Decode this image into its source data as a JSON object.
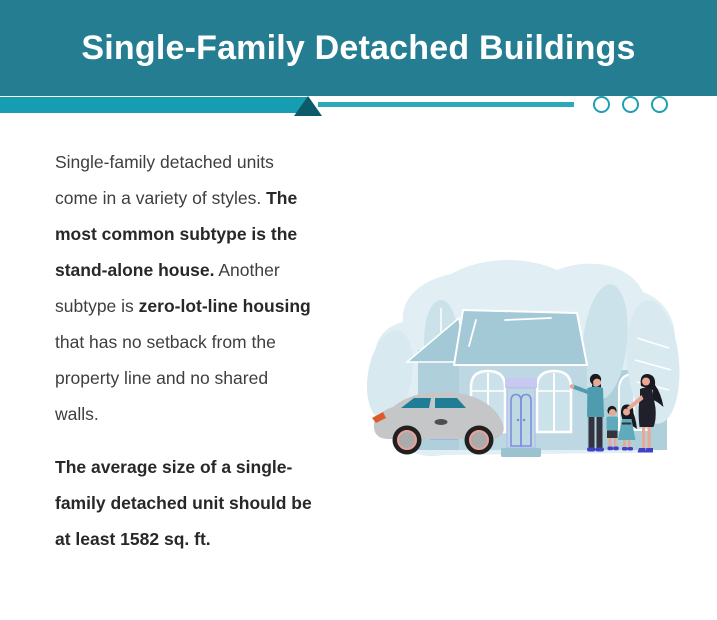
{
  "header": {
    "title": "Single-Family Detached Buildings"
  },
  "divider": {
    "circle_count": 3
  },
  "colors": {
    "page_bg": "#FFFFFF",
    "header_bg": "#247D90",
    "divider_bar": "#169DB2",
    "divider_line": "#2BA9BA",
    "divider_triangle": "#0D5A6A",
    "divider_circle": "#1E9FB2",
    "text_regular": "#3E3E3E",
    "text_bold": "#282828"
  },
  "content": {
    "paragraphs": [
      {
        "lines": [
          [
            {
              "t": "Single-family detached units",
              "b": false
            }
          ],
          [
            {
              "t": "come in a variety of styles. ",
              "b": false
            },
            {
              "t": "The",
              "b": true
            }
          ],
          [
            {
              "t": "most common subtype is the",
              "b": true
            }
          ],
          [
            {
              "t": "stand-alone house.",
              "b": true
            },
            {
              "t": " Another",
              "b": false
            }
          ],
          [
            {
              "t": "subtype is ",
              "b": false
            },
            {
              "t": "zero-lot-line housing",
              "b": true
            }
          ],
          [
            {
              "t": "that has no setback from the",
              "b": false
            }
          ],
          [
            {
              "t": "property line and no shared",
              "b": false
            }
          ],
          [
            {
              "t": "walls.",
              "b": false
            }
          ]
        ]
      },
      {
        "lines": [
          [
            {
              "t": "The average size of a single-",
              "b": true
            }
          ],
          [
            {
              "t": "family detached unit should be",
              "b": true
            }
          ],
          [
            {
              "t": "at least 1582 sq. ft.",
              "b": true
            }
          ]
        ]
      }
    ]
  },
  "illustration": {
    "name": "family-house-illustration",
    "description": "Flat vector scene: light blue detached house with arched windows, gray car parked in front, family of four (dad, son, daughter, mom) standing at right",
    "palette": {
      "blob": "#E1EEF3",
      "leaf": "#CBE2EA",
      "leaf_light": "#D8E9EF",
      "roof": "#A3C8D6",
      "wall": "#BDD8E2",
      "wall_dark": "#AFCFDB",
      "window_glass": "#CBE2EB",
      "door_accent": "#7F8DE0",
      "door_lintel": "#C9C8F0",
      "step": "#9CC2D0",
      "car_body": "#C4C6C8",
      "car_glass": "#1F7E95",
      "headlight": "#DD5A2E",
      "tire": "#202020",
      "hub": "#ABABAB",
      "hub_ring": "#E8A29A",
      "shirt": "#4E9CAE",
      "shirt_kids": "#5FABBC",
      "pants": "#33333F",
      "hair": "#191922",
      "skin": "#E9A894",
      "shoe": "#4040C8",
      "dress": "#20202A"
    }
  }
}
